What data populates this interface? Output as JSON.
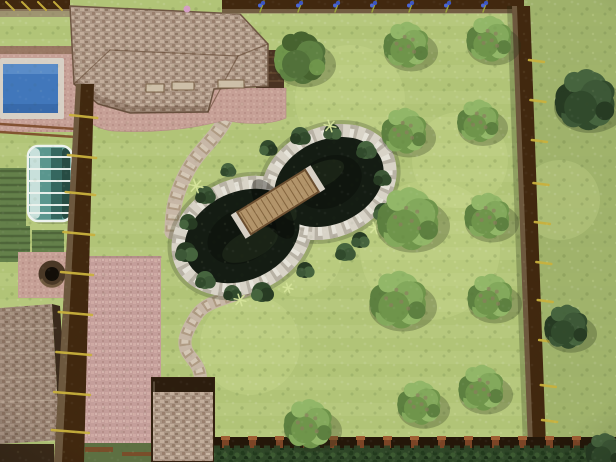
{
  "meta": {
    "description": "3D top-down render of a landscaped backyard garden with pond, wooden bridge, swimming pool, greenhouse, garage, patio and tree-dotted lawn enclosed by a dark wooden fence"
  },
  "scene": {
    "width": 616,
    "height": 462,
    "colors": {
      "grass": "#b6c87d",
      "grassStripe": "#a8bc6f",
      "grassOutside": "#9db069",
      "grassLight": "#d6e49b",
      "fenceDark": "#41280f",
      "fenceCap": "#9a886e",
      "rung": "#c9b13d",
      "roofEdge": "#6e5643",
      "wall": "#4a3322",
      "wallLine": "#6a4c33",
      "pavingEdge": "#8a6a52",
      "poolCoping": "#d7d0c5",
      "poolWater": "#4177bb",
      "poolLight": "#6f9ed4",
      "poolDeep": "#2f5b99",
      "ghFrame": "#eef3ef",
      "ghGlass": [
        "#cfe4df",
        "#5a968e",
        "#35675f",
        "#274c43"
      ],
      "pondWater": "#141c13",
      "pondDeep": "#0b100b",
      "pondAlgae": "#2a3a24",
      "stone": "#d8d3c7",
      "stoneDark": "#b0aa9c",
      "stoneLight": "#ebe8df",
      "bridgeWood": "#b2946a",
      "bridgePlank": "#84653f",
      "bridgeRail": "#6b4e30",
      "path": "#c7b7a6",
      "pathStone": "#a79177",
      "pathLight": "#ddd2c2",
      "bedGreen": "#64804a",
      "bedDark": "#4c6238",
      "treeLight": [
        "#83a95c",
        "#6f954b",
        "#5d8040",
        "#92b768"
      ],
      "treeMid": [
        "#5f8243",
        "#52713a",
        "#6f954b",
        "#47632f"
      ],
      "bushDark": [
        "#3d5837",
        "#314a2c",
        "#273b23",
        "#46643e"
      ],
      "branch": "#8d7c5f",
      "wellRing": "#4a3826",
      "wellHole": "#130e08",
      "wellLip": "#7a6347",
      "towerRim": "#2c1d0e",
      "hedgeLine": "#2e4527",
      "bottomBand": "#241709",
      "post": "#7c4526",
      "postCap": "#9f5f33",
      "beamBrown": "#7c4a28",
      "darkStrip": "#5d7042",
      "chimney": "#d49fc4",
      "skylight": "#cdbfa8"
    },
    "light_patches": [
      [
        430,
        250,
        70
      ],
      [
        250,
        345,
        50
      ],
      [
        350,
        100,
        55
      ],
      [
        300,
        255,
        42
      ],
      [
        460,
        160,
        48
      ],
      [
        560,
        200,
        40
      ]
    ],
    "beds": [
      [
        0,
        168,
        26,
        58
      ],
      [
        0,
        226,
        30,
        36
      ],
      [
        32,
        230,
        32,
        30
      ]
    ],
    "pool": {
      "terrace": [
        0,
        46,
        77,
        86
      ],
      "edge_band": [
        0,
        46,
        77,
        8
      ],
      "coping": [
        0,
        58,
        64,
        61
      ],
      "water": [
        3,
        64,
        55,
        49
      ]
    },
    "rails_below_pool": [
      [
        0,
        124,
        76,
        129
      ],
      [
        0,
        132,
        76,
        137
      ]
    ],
    "gate_topleft": {
      "band": [
        0,
        0,
        70,
        11
      ],
      "cap": [
        0,
        9,
        70,
        8
      ],
      "rungs": 4
    },
    "greenhouse": {
      "box": [
        28,
        146,
        44,
        75
      ],
      "ribs_y": [
        157,
        169,
        181,
        193,
        205,
        213
      ]
    },
    "well": {
      "pad": [
        18,
        252,
        56,
        46
      ],
      "cx": 52,
      "cy": 274,
      "r_out": 13.5,
      "r_in": 7
    },
    "garage": {
      "roof_poly": "0,308 52,304 60,440 0,444",
      "edge_poly": "52,304 60,306 68,440 60,440",
      "below": [
        0,
        444,
        54,
        18
      ]
    },
    "patio": {
      "poly": "89,256 161,256 161,462 83,462"
    },
    "bottom_left": {
      "strip": [
        83,
        443,
        131,
        19
      ],
      "beams": [
        [
          85,
          447,
          28,
          5
        ],
        [
          122,
          452,
          30,
          4
        ],
        [
          152,
          444,
          30,
          5
        ]
      ]
    },
    "paths": [
      {
        "d": "M230,110 C218,138 200,148 188,170 C176,192 172,208 172,232",
        "w": 15
      },
      {
        "d": "M250,288 C228,300 206,300 196,316 C186,332 180,344 190,356 C198,366 202,372 200,386",
        "w": 13
      }
    ],
    "pond": {
      "lobes": [
        {
          "cx": 242,
          "cy": 236,
          "rx": 60,
          "ry": 44,
          "rot": -25
        },
        {
          "cx": 329,
          "cy": 182,
          "rx": 57,
          "ry": 42,
          "rot": -25
        }
      ],
      "algae": [
        [
          250,
          245,
          30,
          14,
          -25
        ],
        [
          320,
          175,
          26,
          12,
          -25
        ],
        [
          285,
          205,
          18,
          8,
          58
        ]
      ],
      "shrubs": [
        [
          205,
          195,
          9
        ],
        [
          188,
          222,
          8
        ],
        [
          186,
          252,
          10
        ],
        [
          205,
          280,
          9
        ],
        [
          232,
          293,
          8
        ],
        [
          262,
          292,
          10
        ],
        [
          305,
          270,
          8
        ],
        [
          345,
          252,
          9
        ],
        [
          300,
          136,
          9
        ],
        [
          268,
          148,
          8
        ],
        [
          332,
          132,
          8
        ],
        [
          366,
          150,
          9
        ],
        [
          382,
          178,
          8
        ],
        [
          383,
          212,
          9
        ],
        [
          360,
          240,
          8
        ],
        [
          228,
          170,
          7
        ]
      ],
      "tufts": [
        [
          196,
          186,
          7
        ],
        [
          240,
          300,
          6
        ],
        [
          330,
          126,
          6
        ],
        [
          375,
          228,
          6
        ],
        [
          288,
          288,
          5
        ]
      ]
    },
    "bridge": {
      "cx": 278,
      "cy": 202,
      "len": 80,
      "w": 26,
      "angle": 58
    },
    "house": {
      "roof_poly": "70,6 240,14 268,44 268,86 214,89 208,112 130,113 98,104 74,84",
      "hip_shade": "74,84 98,104 130,113 208,112 206,106 132,106 102,97 80,80",
      "ridges": [
        [
          74,
          84,
          110,
          50
        ],
        [
          110,
          50,
          238,
          56
        ],
        [
          238,
          56,
          268,
          44
        ],
        [
          238,
          56,
          208,
          112
        ]
      ],
      "wall": [
        256,
        50,
        28,
        38
      ],
      "skylights": [
        [
          146,
          84,
          18,
          8
        ],
        [
          172,
          82,
          22,
          8
        ],
        [
          218,
          80,
          26,
          8
        ]
      ],
      "terrace_d": "M82,88 L286,88 L286,118 C268,126 240,124 225,120 C190,130 150,133 112,131 C94,128 84,120 82,112 Z",
      "chimney": [
        187,
        9,
        3.5
      ]
    },
    "tower": {
      "box": [
        152,
        378,
        62,
        84
      ],
      "rim": [
        152,
        378,
        62,
        14
      ]
    },
    "fences": {
      "top": {
        "band": [
          222,
          0,
          302,
          13
        ],
        "cap": [
          222,
          9,
          302,
          5
        ],
        "flowers_x": [
          260,
          298,
          335,
          372,
          409,
          446,
          483
        ]
      },
      "left": {
        "poly": "76,84 94,84 84,462 54,462",
        "cap": "76,84 81,84 62,462 54,462",
        "rungs_y": [
          115,
          155,
          192,
          232,
          272,
          312,
          352,
          392,
          430
        ]
      },
      "right": {
        "poly": "512,6 530,6 546,446 528,446",
        "cap": "512,6 517,6 533,446 528,446",
        "shadow": "507,6 512,6 528,446 523,446",
        "rungs_y": [
          60,
          100,
          140,
          183,
          222,
          262,
          300,
          340,
          385,
          420
        ]
      },
      "bottom": {
        "band": [
          214,
          437,
          402,
          15
        ],
        "hedge": [
          214,
          448,
          402,
          14
        ],
        "post_from": 222,
        "post_to": 606,
        "post_step": 27
      }
    },
    "outside_poly": "524,0 616,0 616,462 536,462 526,100",
    "trees": [
      {
        "x": 300,
        "y": 58,
        "r": 31,
        "kind": "mid"
      },
      {
        "x": 406,
        "y": 45,
        "r": 27,
        "kind": "light"
      },
      {
        "x": 489,
        "y": 39,
        "r": 27,
        "kind": "light"
      },
      {
        "x": 404,
        "y": 131,
        "r": 27,
        "kind": "light"
      },
      {
        "x": 478,
        "y": 121,
        "r": 25,
        "kind": "light"
      },
      {
        "x": 408,
        "y": 219,
        "r": 37,
        "kind": "light"
      },
      {
        "x": 487,
        "y": 216,
        "r": 27,
        "kind": "light"
      },
      {
        "x": 398,
        "y": 300,
        "r": 34,
        "kind": "light"
      },
      {
        "x": 490,
        "y": 297,
        "r": 27,
        "kind": "light"
      },
      {
        "x": 308,
        "y": 424,
        "r": 29,
        "kind": "light"
      },
      {
        "x": 419,
        "y": 403,
        "r": 26,
        "kind": "light"
      },
      {
        "x": 481,
        "y": 388,
        "r": 27,
        "kind": "light"
      }
    ],
    "bushes": [
      {
        "x": 585,
        "y": 100,
        "r": 36
      },
      {
        "x": 566,
        "y": 327,
        "r": 26
      },
      {
        "x": 604,
        "y": 452,
        "r": 22
      }
    ]
  }
}
